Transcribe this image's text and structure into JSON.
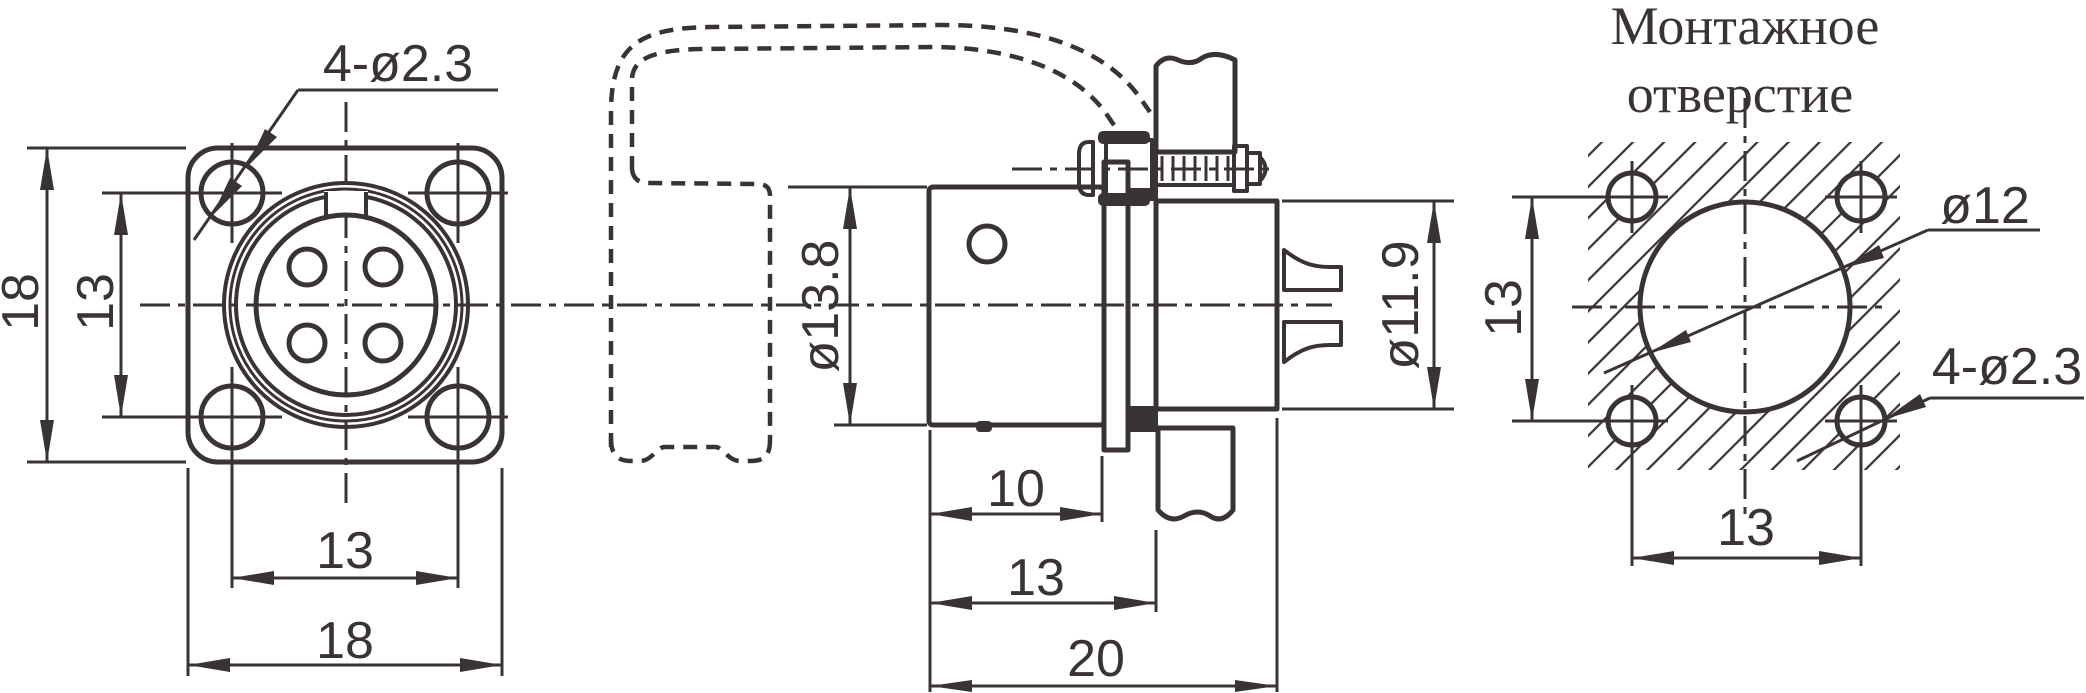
{
  "drawing": {
    "title": {
      "line1": "Монтажное",
      "line2": "отверстие"
    },
    "front_view": {
      "mount_holes": "4-ø2.3",
      "flange_size_v": "18",
      "hole_pitch_v": "13",
      "hole_pitch_h": "13",
      "flange_size_h": "18"
    },
    "side_view": {
      "body_dia": "ø13.8",
      "insert_dia": "ø11.9",
      "len_body": "10",
      "len_to_panel": "13",
      "len_total": "20"
    },
    "mount_view": {
      "hole_pitch_v": "13",
      "hole_dia": "ø12",
      "mount_holes": "4-ø2.3",
      "hole_pitch_h": "13"
    },
    "colors": {
      "line": "#3a3335",
      "background": "#ffffff"
    }
  }
}
